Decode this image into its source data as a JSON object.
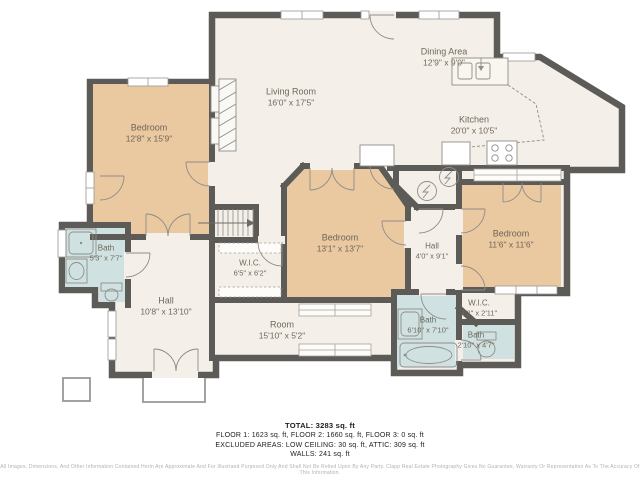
{
  "rooms": [
    {
      "id": "bedroom-left",
      "name": "Bedroom",
      "dims": "12'8\" x 15'9\""
    },
    {
      "id": "living-room",
      "name": "Living Room",
      "dims": "16'0\" x 17'5\""
    },
    {
      "id": "dining-area",
      "name": "Dining Area",
      "dims": "12'9\" x 9'0\""
    },
    {
      "id": "kitchen",
      "name": "Kitchen",
      "dims": "20'0\" x 10'5\""
    },
    {
      "id": "bath-left",
      "name": "Bath",
      "dims": "5'3\" x 7'7\""
    },
    {
      "id": "hall-left",
      "name": "Hall",
      "dims": "10'8\" x 13'10\""
    },
    {
      "id": "wic-center",
      "name": "W.I.C.",
      "dims": "6'5\" x 6'2\""
    },
    {
      "id": "bedroom-center",
      "name": "Bedroom",
      "dims": "13'1\" x 13'7\""
    },
    {
      "id": "room",
      "name": "Room",
      "dims": "15'10\" x 5'2\""
    },
    {
      "id": "hall-right",
      "name": "Hall",
      "dims": "4'0\" x 9'1\""
    },
    {
      "id": "bedroom-right",
      "name": "Bedroom",
      "dims": "11'6\" x 11'6\""
    },
    {
      "id": "bath-center",
      "name": "Bath",
      "dims": "6'10\" x 7'10\""
    },
    {
      "id": "wic-right",
      "name": "W.I.C.",
      "dims": "4'2\" x 2'11\""
    },
    {
      "id": "bath-right",
      "name": "Bath",
      "dims": "2'10\" x 4'7\""
    }
  ],
  "summary": {
    "total": "TOTAL: 3283 sq. ft",
    "floors": "FLOOR 1: 1623 sq. ft, FLOOR 2: 1660 sq. ft, FLOOR 3: 0 sq. ft",
    "excluded": "EXCLUDED AREAS: LOW CEILING: 30 sq. ft, ATTIC: 309 sq. ft",
    "walls": "WALLS: 241 sq. ft"
  },
  "disclaimer": "All Images, Dimensions, And Other Information Contained Herin Are Approximate And For Illustraed Purposed Only And Shall Not Be Relied Upon By Any Party. Clapp Real Estate Photography Gives No Guarantee, Warranty Or Representation As To The Accuracy Of This Information.",
  "colors": {
    "wall": "#5d5b58",
    "bedroom_fill": "#eac8a0",
    "bath_fill": "#cfe2e1",
    "floor_fill": "#f4f0e9"
  },
  "icons": {
    "stairs": "stairs-icon",
    "fireplace": "fireplace-icon",
    "stove": "stove-burners-icon",
    "kitchen_sink": "kitchen-sink-icon",
    "shower": "shower-icon",
    "bathtub": "bathtub-icon",
    "toilet": "toilet-icon",
    "utility": "lightning-icon",
    "door": "door-swing-arc-icon",
    "window": "window-icon"
  }
}
